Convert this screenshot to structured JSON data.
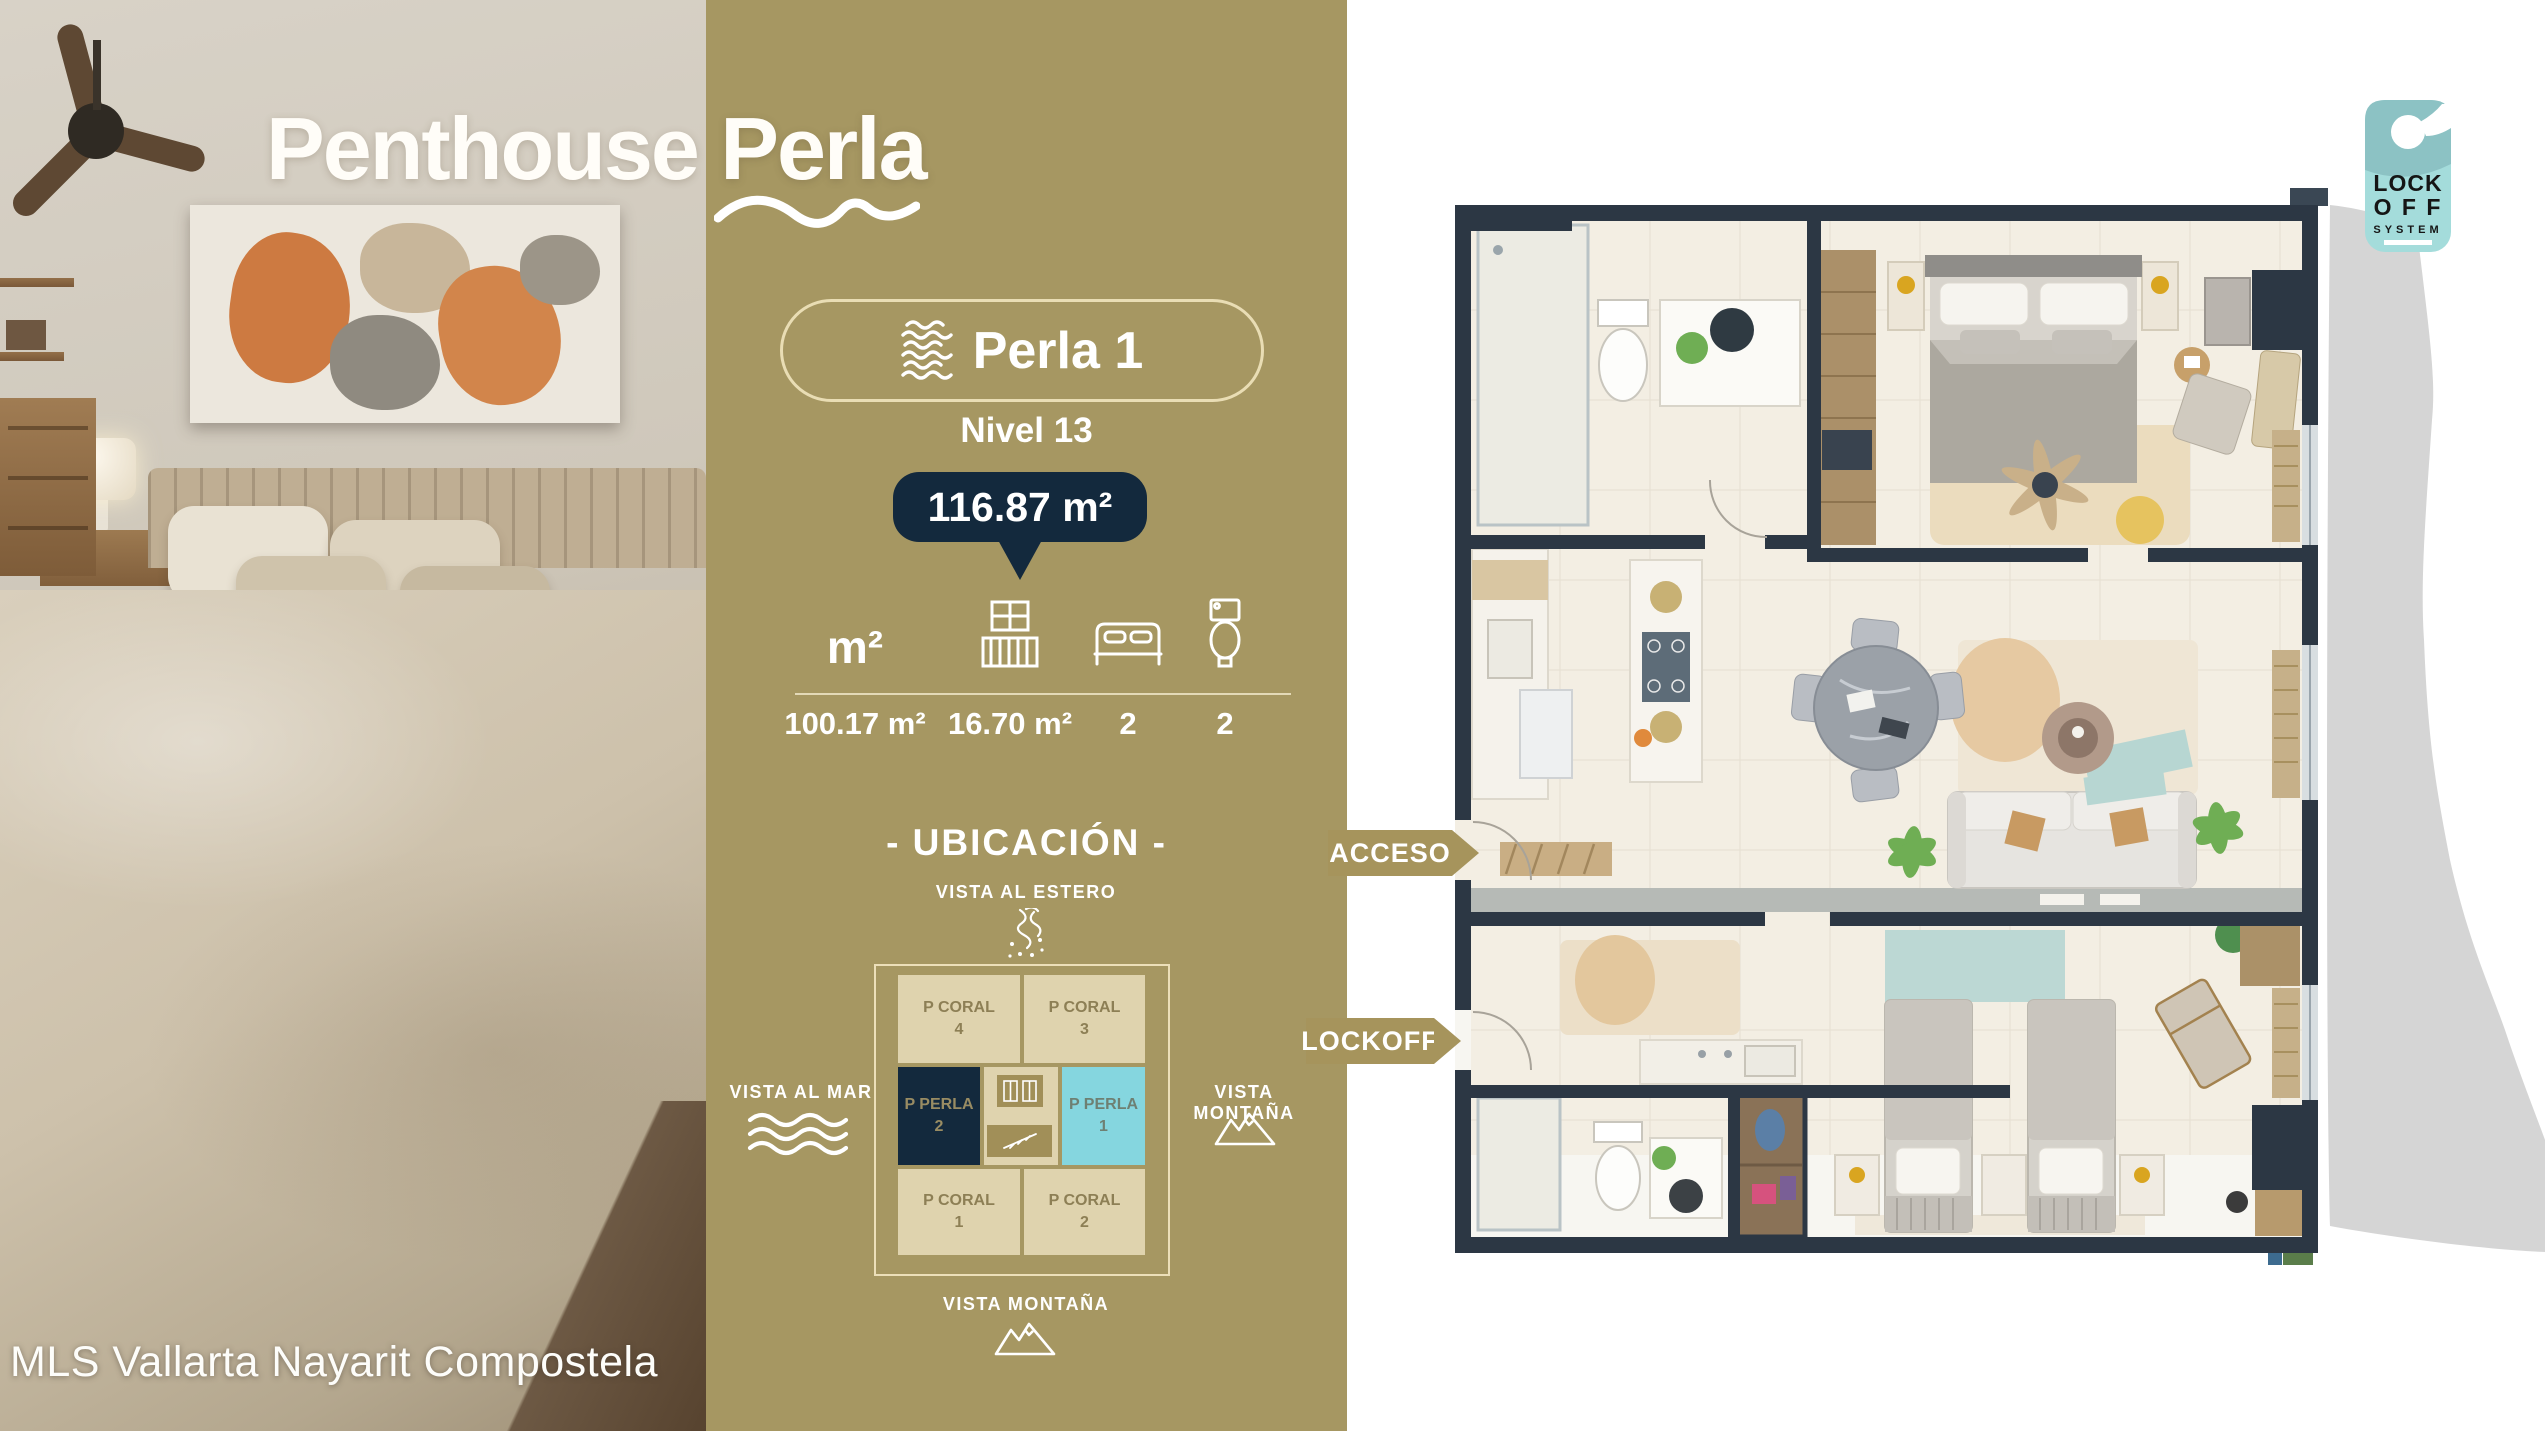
{
  "watermark": "MLS Vallarta Nayarit Compostela",
  "hero": {
    "title": "Penthouse Perla"
  },
  "panel": {
    "unit_badge": "Perla 1",
    "level": "Nivel 13",
    "total_area": "116.87 m²",
    "stats": {
      "area_label": "m²",
      "values": [
        "100.17 m²",
        "16.70 m²",
        "2",
        "2"
      ]
    },
    "ubicacion": {
      "heading": "- UBICACIÓN -",
      "views": {
        "top": "VISTA AL ESTERO",
        "left": "VISTA AL MAR",
        "right": "VISTA MONTAÑA",
        "bottom": "VISTA MONTAÑA"
      },
      "cells": [
        {
          "name": "P CORAL",
          "num": "4"
        },
        {
          "name": "P CORAL",
          "num": "3"
        },
        {
          "name": "P PERLA",
          "num": "2"
        },
        {
          "name": "P PERLA",
          "num": "1"
        },
        {
          "name": "P CORAL",
          "num": "1"
        },
        {
          "name": "P CORAL",
          "num": "2"
        }
      ]
    }
  },
  "floorplan": {
    "acceso_tag": "ACCESO",
    "lockoff_tag": "LOCKOFF"
  },
  "lockoff_badge": {
    "line1": "LOCK",
    "line2": "O F F",
    "line3": "SYSTEM"
  },
  "colors": {
    "gold_panel": "#a69762",
    "navy": "#13293d",
    "cyan_highlight": "#85d6df",
    "cell_beige": "#dfd3ae",
    "hanger_teal": "#a4dcdb",
    "wall_dark": "#2c3744",
    "swoosh_gray": "#d5d5d5"
  }
}
